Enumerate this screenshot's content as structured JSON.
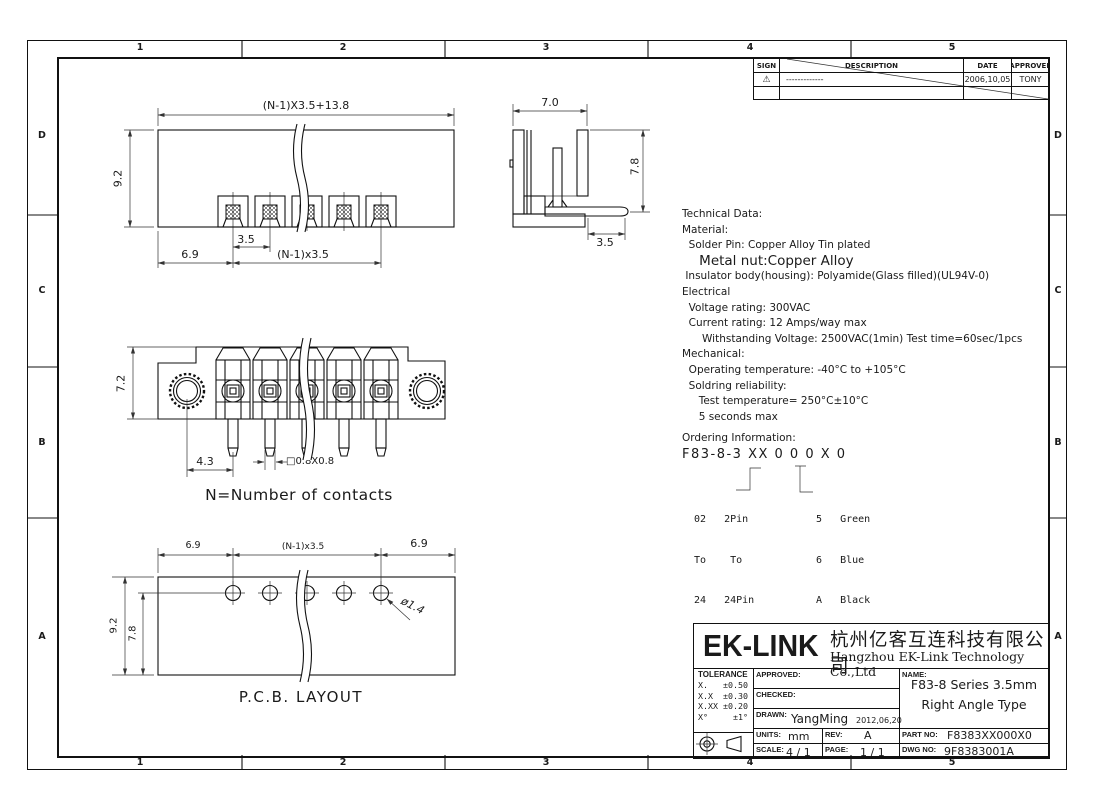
{
  "colors": {
    "line": "#1a1a1a",
    "bg": "#ffffff"
  },
  "zones": {
    "cols": [
      "1",
      "2",
      "3",
      "4",
      "5"
    ],
    "rows": [
      "D",
      "C",
      "B",
      "A"
    ]
  },
  "revision": {
    "headers": [
      "SIGN",
      "DESCRIPTION",
      "DATE",
      "APPROVER"
    ],
    "row": {
      "sign": "⚠",
      "desc": "-------------",
      "date": "2006,10,05",
      "approver": "TONY"
    }
  },
  "tech": {
    "lines": [
      "Technical Data:",
      "Material:",
      "  Solder Pin: Copper Alloy Tin plated",
      "    Metal nut:Copper Alloy",
      " Insulator body(housing): Polyamide(Glass filled)(UL94V-0)",
      "Electrical",
      "  Voltage rating: 300VAC",
      "  Current rating: 12 Amps/way max",
      "      Withstanding Voltage: 2500VAC(1min) Test time=60sec/1pcs",
      "Mechanical:",
      "  Operating temperature: -40°C to +105°C",
      "  Soldring reliability:",
      "     Test temperature= 250°C±10°C",
      "     5 seconds max",
      "Ordering Information:",
      "F83-8-3 XX 0 0 0 X 0"
    ]
  },
  "ordering": {
    "left": [
      "02   2Pin",
      "To    To",
      "24   24Pin"
    ],
    "right": [
      "5   Green",
      "6   Blue",
      "A   Black"
    ]
  },
  "dims": {
    "top": {
      "overall": "(N-1)X3.5+13.8",
      "height": "9.2",
      "pitch": "3.5",
      "edge": "6.9",
      "span": "(N-1)x3.5"
    },
    "side": {
      "width": "7.0",
      "height": "7.8",
      "tail": "3.5"
    },
    "front": {
      "height": "7.2",
      "nut": "4.3",
      "pin": "□0.8X0.8",
      "note": "N=Number of contacts"
    },
    "pcb": {
      "left": "6.9",
      "span": "(N-1)x3.5",
      "right": "6.9",
      "height": "9.2",
      "row": "7.8",
      "dia": "ø1.4",
      "label": "P.C.B. LAYOUT"
    }
  },
  "title_block": {
    "logo": "EK-LINK",
    "company_cn": "杭州亿客互连科技有限公司",
    "company_en": "Hangzhou EK-Link Technology Co.,Ltd",
    "tolerance_title": "TOLERANCE",
    "tolerance_rows": [
      "X.   ±0.50",
      "X.X  ±0.30",
      "X.XX ±0.20",
      "X°     ±1°"
    ],
    "approved_label": "APPROVED:",
    "checked_label": "CHECKED:",
    "drawn_label": "DRAWN:",
    "drawn_value": "YangMing",
    "drawn_date": "2012,06,20",
    "units_label": "UNITS:",
    "units_value": "mm",
    "rev_label": "REV:",
    "rev_value": "A",
    "scale_label": "SCALE:",
    "scale_value": "4 / 1",
    "page_label": "PAGE:",
    "page_value": "1 / 1",
    "name_label": "NAME:",
    "name_line1": "F83-8 Series 3.5mm",
    "name_line2": "Right Angle Type",
    "part_label": "PART NO:",
    "part_value": "F8383XX000X0",
    "dwg_label": "DWG NO:",
    "dwg_value": "9F8383001A"
  }
}
